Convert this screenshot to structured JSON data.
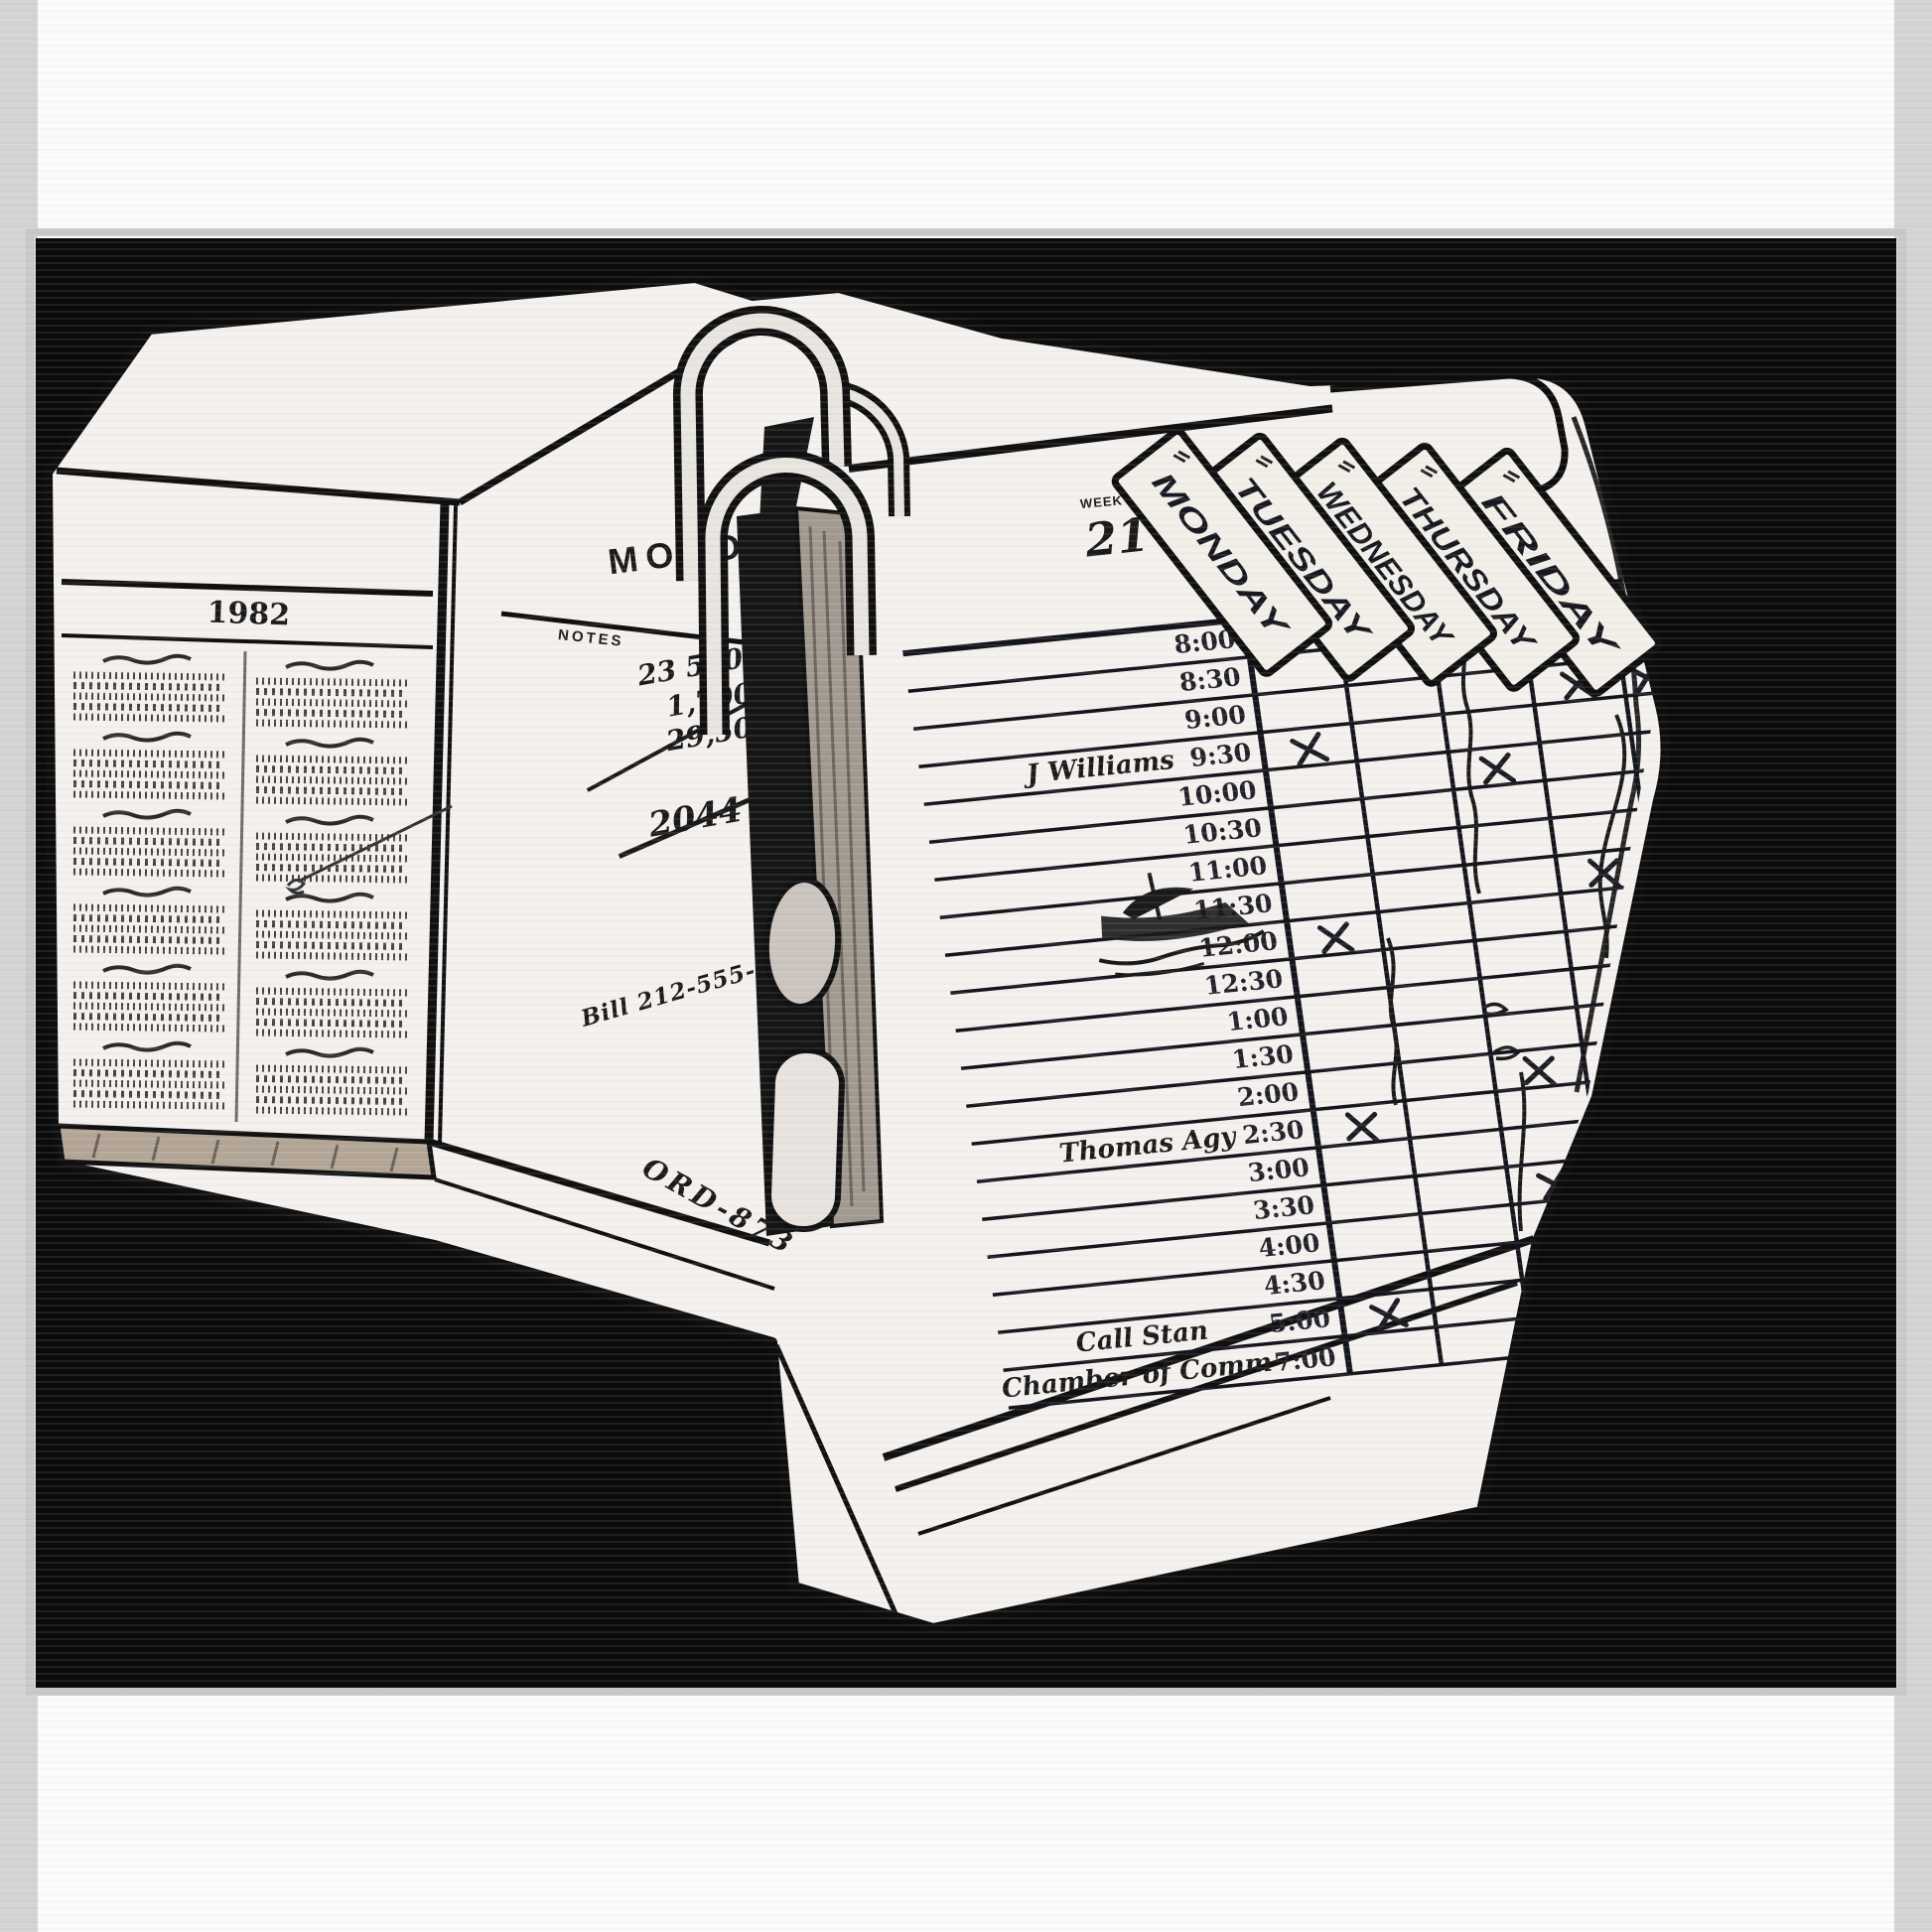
{
  "artwork": {
    "description": "black and white pop-art illustration of an open ring-binder day planner",
    "background_color": "#0a0a0a",
    "paper_color": "#f5f1ee",
    "ink_color": "#161616"
  },
  "left_page": {
    "year_header": "1982",
    "calendar_columns": 2,
    "month_blocks": 12
  },
  "notes_page": {
    "day_title": "MONDAY",
    "notes_label": "NOTES",
    "calc_lines": [
      "23 500",
      "1,700",
      "29,500",
      ".07"
    ],
    "calc_result": "2044",
    "phone_note": "Bill 212-555-0820",
    "order_note": "ORD-873"
  },
  "right_page": {
    "week_label": "WEEK",
    "week_number": "21",
    "day_tabs": [
      "MONDAY",
      "TUESDAY",
      "WEDNESDAY",
      "THURSDAY",
      "FRIDAY"
    ],
    "time_slots": [
      "8:00",
      "8:30",
      "9:00",
      "9:30",
      "10:00",
      "10:30",
      "11:00",
      "11:30",
      "12:00",
      "12:30",
      "1:00",
      "1:30",
      "2:00",
      "2:30",
      "3:00",
      "3:30",
      "4:00",
      "4:30",
      "5:00"
    ],
    "extra_slot": "7:00",
    "entries": [
      {
        "time": "9:30",
        "text": "J Williams"
      },
      {
        "time": "2:30",
        "text": "Thomas Agy"
      },
      {
        "time": "5:00",
        "text": "Call Stan"
      },
      {
        "time": "7:00",
        "text": "Chamber of Comm"
      }
    ],
    "x_marks": [
      {
        "day": "MONDAY",
        "time": "9:30"
      },
      {
        "day": "MONDAY",
        "time": "12:00"
      },
      {
        "day": "MONDAY",
        "time": "2:30"
      },
      {
        "day": "MONDAY",
        "time": "5:00"
      },
      {
        "day": "WEDNESDAY",
        "time": "10:00"
      },
      {
        "day": "WEDNESDAY",
        "time": "2:00"
      },
      {
        "day": "WEDNESDAY",
        "time": "3:30"
      },
      {
        "day": "THURSDAY",
        "time": "9:00"
      },
      {
        "day": "THURSDAY",
        "time": "11:30"
      },
      {
        "day": "FRIDAY",
        "time": "9:00"
      }
    ],
    "doodles": [
      "sailboat-sketch",
      "wednesday-scribble-line",
      "thursday-scribble-line",
      "friday-scribble-line",
      "tuesday-scribble-line"
    ]
  }
}
